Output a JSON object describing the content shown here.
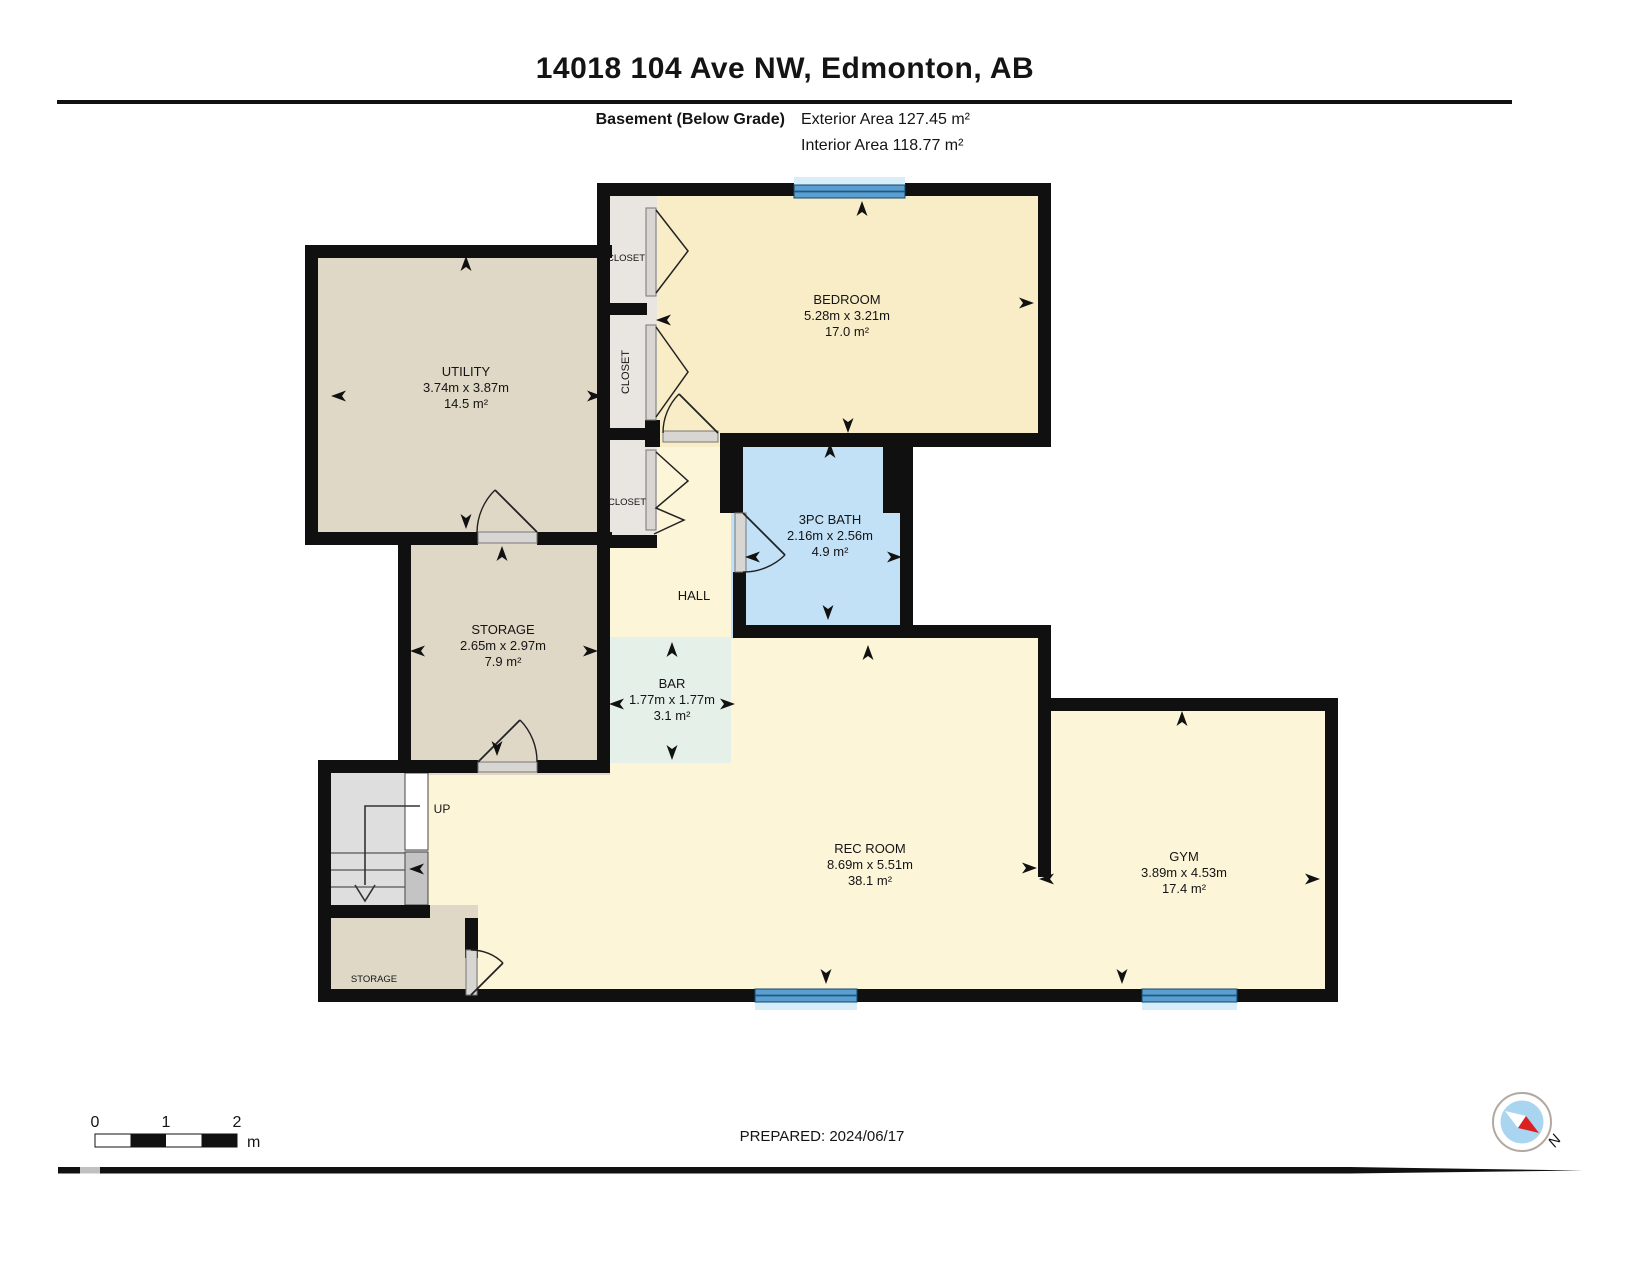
{
  "header": {
    "title": "14018 104 Ave NW, Edmonton, AB",
    "floor_label": "Basement (Below Grade)",
    "exterior_area": "Exterior Area 127.45 m²",
    "interior_area": "Interior Area 118.77 m²"
  },
  "rooms": [
    {
      "id": "utility",
      "name": "UTILITY",
      "dims": "3.74m x 3.87m",
      "area": "14.5 m²",
      "x": 466,
      "y": 376
    },
    {
      "id": "bedroom",
      "name": "BEDROOM",
      "dims": "5.28m x 3.21m",
      "area": "17.0 m²",
      "x": 847,
      "y": 304
    },
    {
      "id": "bath",
      "name": "3PC BATH",
      "dims": "2.16m x 2.56m",
      "area": "4.9 m²",
      "x": 830,
      "y": 524
    },
    {
      "id": "storage",
      "name": "STORAGE",
      "dims": "2.65m x 2.97m",
      "area": "7.9 m²",
      "x": 503,
      "y": 634
    },
    {
      "id": "bar",
      "name": "BAR",
      "dims": "1.77m x 1.77m",
      "area": "3.1 m²",
      "x": 672,
      "y": 688
    },
    {
      "id": "rec-room",
      "name": "REC ROOM",
      "dims": "8.69m x 5.51m",
      "area": "38.1 m²",
      "x": 870,
      "y": 853
    },
    {
      "id": "gym",
      "name": "GYM",
      "dims": "3.89m x 4.53m",
      "area": "17.4 m²",
      "x": 1184,
      "y": 861
    }
  ],
  "small_labels": [
    {
      "id": "closet-1",
      "text": "CLOSET",
      "x": 626,
      "y": 261,
      "size": 9.5,
      "rotate": 0
    },
    {
      "id": "closet-2",
      "text": "CLOSET",
      "x": 629,
      "y": 372,
      "size": 11,
      "rotate": -90
    },
    {
      "id": "closet-3",
      "text": "CLOSET",
      "x": 627,
      "y": 505,
      "size": 9.5,
      "rotate": 0
    },
    {
      "id": "hall",
      "text": "HALL",
      "x": 694,
      "y": 600,
      "size": 13,
      "rotate": 0
    },
    {
      "id": "stairs-up",
      "text": "UP",
      "x": 442,
      "y": 813,
      "size": 12,
      "rotate": 0
    },
    {
      "id": "storage-2",
      "text": "STORAGE",
      "x": 374,
      "y": 982,
      "size": 9.5,
      "rotate": 0
    }
  ],
  "footer": {
    "prepared": "PREPARED: 2024/06/17",
    "scale": {
      "ticks": [
        "0",
        "1",
        "2"
      ],
      "unit": "m"
    },
    "compass_label": "N"
  },
  "colors": {
    "wall": "#101010",
    "cream": "#fdf5d8",
    "bedroom_cream": "#f9edc7",
    "tan": "#e0d8c6",
    "bath_blue": "#c2e1f7",
    "bar_mint": "#e5f0e9",
    "closet_gray": "#e9e6e1",
    "stair_gray": "#dedede",
    "stair_dark": "#c4c4c4",
    "threshold": "#d8d6d2",
    "window_blue": "#5b9ecf",
    "window_dark": "#1b5b86",
    "window_pale": "#d8edfa",
    "compass_blue": "#a9d5f1",
    "needle_red": "#d92121",
    "text": "#141414"
  }
}
